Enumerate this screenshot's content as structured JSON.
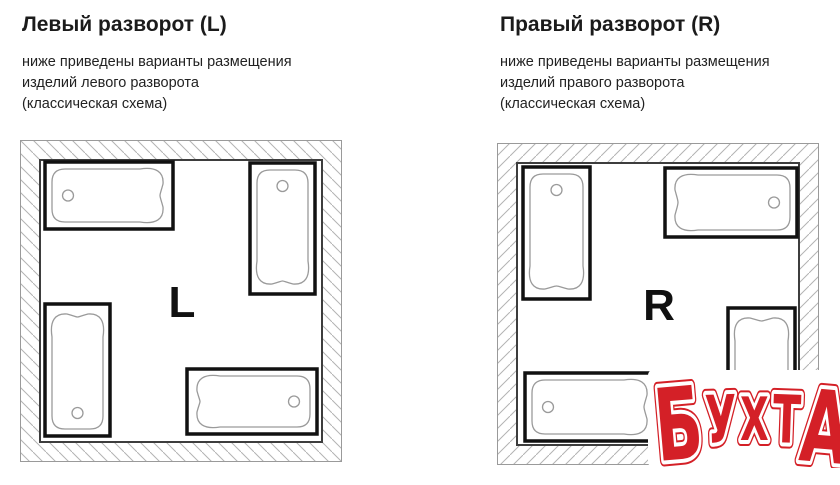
{
  "page": {
    "background": "#ffffff"
  },
  "panels": [
    {
      "title": "Левый разворот (L)",
      "description_lines": [
        "ниже приведены варианты размещения",
        "изделий левого разворота",
        "(классическая схема)"
      ],
      "letter": "L",
      "hatch_direction": "backslash",
      "room": {
        "size": 322,
        "wall_thickness": 20
      },
      "tubs": [
        {
          "x": 25,
          "y": 22,
          "w": 128,
          "h": 67,
          "drain": "left"
        },
        {
          "x": 230,
          "y": 23,
          "w": 65,
          "h": 131,
          "drain": "top"
        },
        {
          "x": 25,
          "y": 164,
          "w": 65,
          "h": 132,
          "drain": "bottom"
        },
        {
          "x": 167,
          "y": 229,
          "w": 130,
          "h": 65,
          "drain": "right"
        }
      ]
    },
    {
      "title": "Правый разворот (R)",
      "description_lines": [
        "ниже приведены варианты размещения",
        "изделий правого разворота",
        "(классическая схема)"
      ],
      "letter": "R",
      "hatch_direction": "slash",
      "room": {
        "size": 322,
        "wall_thickness": 20
      },
      "tubs": [
        {
          "x": 26,
          "y": 24,
          "w": 67,
          "h": 132,
          "drain": "top"
        },
        {
          "x": 168,
          "y": 25,
          "w": 132,
          "h": 69,
          "drain": "right"
        },
        {
          "x": 28,
          "y": 230,
          "w": 132,
          "h": 68,
          "drain": "left"
        },
        {
          "x": 231,
          "y": 165,
          "w": 67,
          "h": 132,
          "drain": "bottom"
        }
      ]
    }
  ],
  "watermark": {
    "text": "БУХТА",
    "fill": "#d42027",
    "halo": "#ffffff"
  },
  "colors": {
    "hatch": "#b3b3b3",
    "outer_border": "#9a9a9a",
    "inner_border": "#3d3d3d",
    "tub_frame": "#111111",
    "tub_outline": "#9a9a9a",
    "letter": "#111111",
    "text": "#1b1b1b"
  }
}
